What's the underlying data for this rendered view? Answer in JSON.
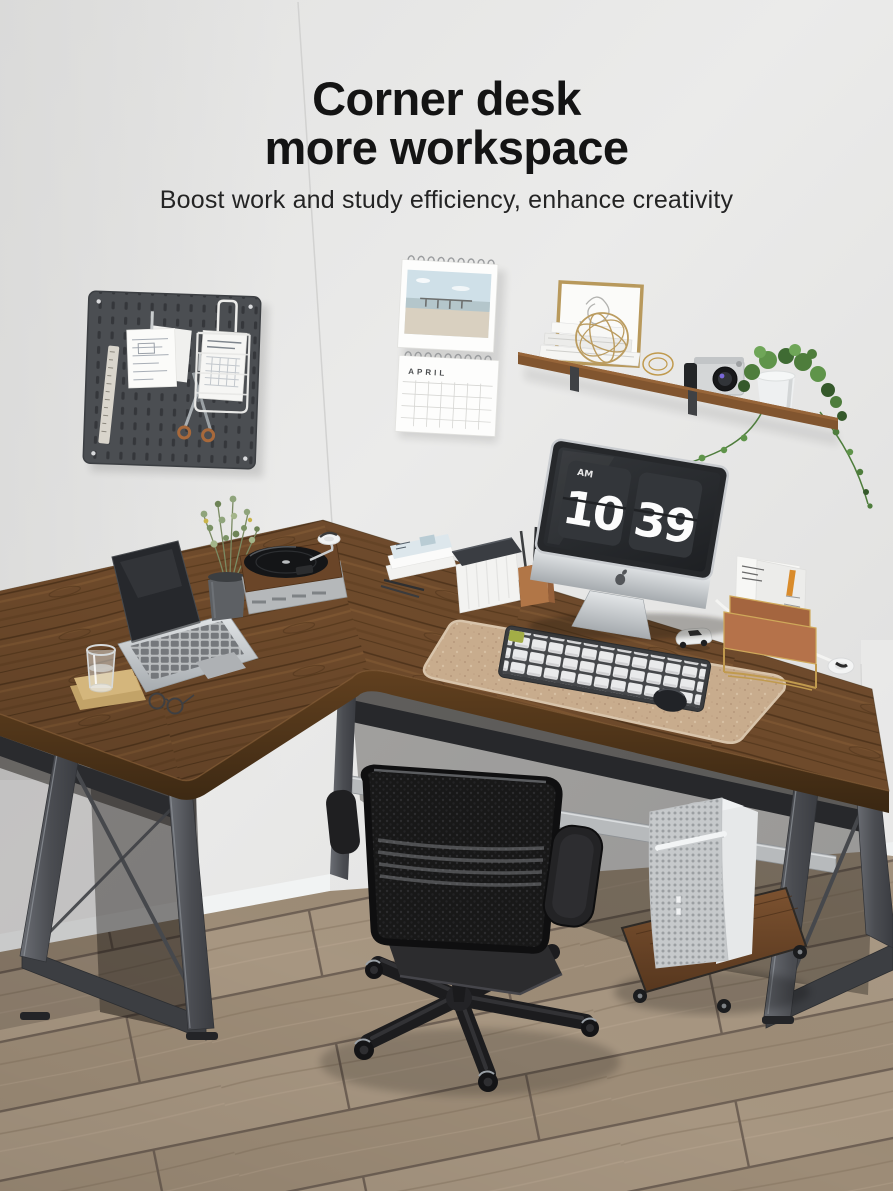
{
  "page": {
    "width": 893,
    "height": 1191,
    "background": "#e6e6e5"
  },
  "hero": {
    "title_line1": "Corner desk",
    "title_line2": "more workspace",
    "subtitle": "Boost work and study efficiency, enhance creativity",
    "text_color": "#141414"
  },
  "scene": {
    "imac_clock": {
      "period": "AM",
      "hour": "10",
      "minute": "39"
    },
    "calendar": {
      "month": "APRIL"
    },
    "colors": {
      "wall": "#e6e6e5",
      "floor": "#a39180",
      "desk_wood": "#6e4a2b",
      "desk_edge": "#4e3419",
      "metal_frame": "#53565c",
      "chair_black": "#1f1f21",
      "desk_mat": "#c8ac8d",
      "shelf_wood": "#81552f",
      "gold_accent": "#c09a4e",
      "clock_digits": "#fcfcfc"
    }
  }
}
